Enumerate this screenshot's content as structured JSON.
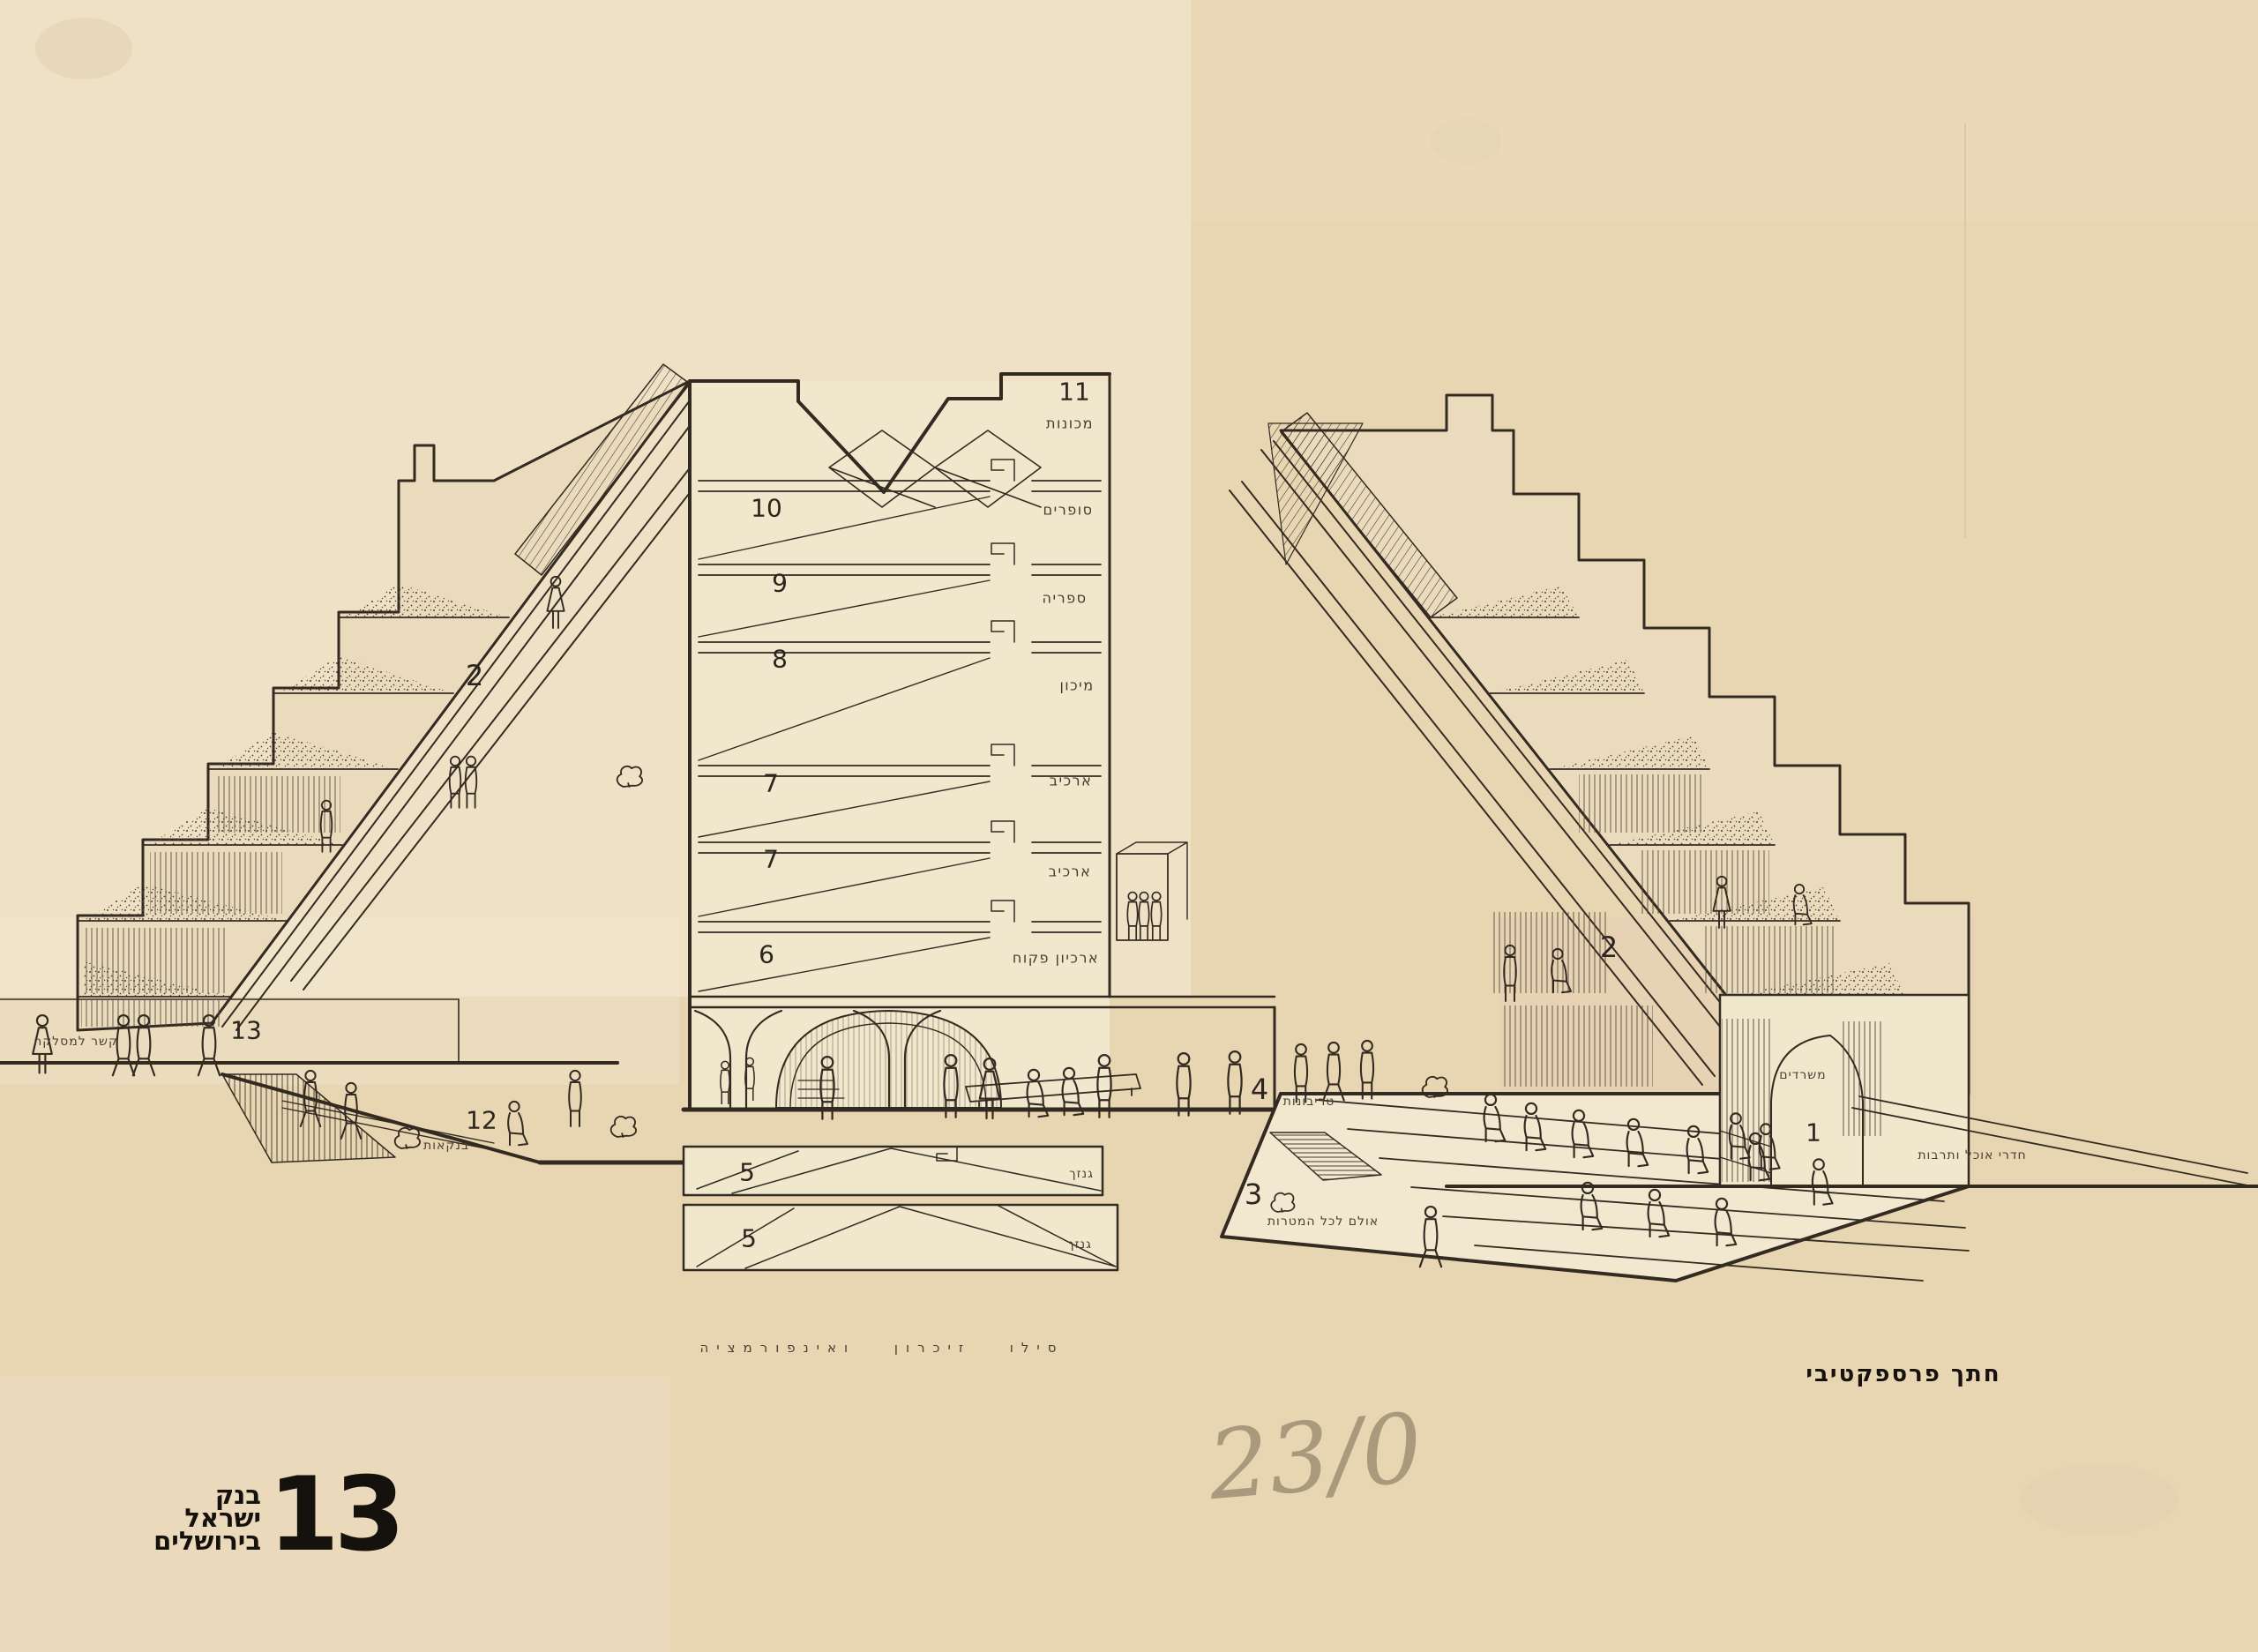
{
  "sheet": {
    "caption": "חתך פרספקטיבי",
    "base_caption": "סילו זיכרון ואינפורמציה",
    "handwritten_note": "23/0",
    "logo": {
      "number": "13",
      "line1": "בנק",
      "line2": "ישראל",
      "line3": "בירושלים"
    }
  },
  "tower": {
    "floors": [
      {
        "num": "11",
        "label": "מכונות"
      },
      {
        "num": "10",
        "label": "סופרים"
      },
      {
        "num": "9",
        "label": "ספריה"
      },
      {
        "num": "8",
        "label": "מיכון"
      },
      {
        "num": "7",
        "label": "ארכיב"
      },
      {
        "num": "7",
        "label": "ארכיב"
      },
      {
        "num": "6",
        "label": "ארכיון פקוח"
      },
      {
        "num": "5",
        "label": "גנזך"
      },
      {
        "num": "5",
        "label": "גנזך"
      }
    ]
  },
  "zones": {
    "left_terraces": {
      "num": "2"
    },
    "right_terraces": {
      "num": "2"
    },
    "clearing_link": {
      "num": "13",
      "label": "קשר למסלקה"
    },
    "banking": {
      "num": "12",
      "label": "בנקאות"
    },
    "tribunes": {
      "num": "4",
      "label": "טריבונות"
    },
    "hall": {
      "num": "3",
      "label": "אולם לכל המטרות"
    },
    "entrance": {
      "num": "1"
    },
    "offices_label": "משרדים",
    "dining_label": "חדרי אוכל ותרבות"
  },
  "colors": {
    "paper": "#e8d5b2",
    "paper_light": "#f3ead6",
    "ink": "#332b22",
    "pencil": "#8d8068"
  }
}
